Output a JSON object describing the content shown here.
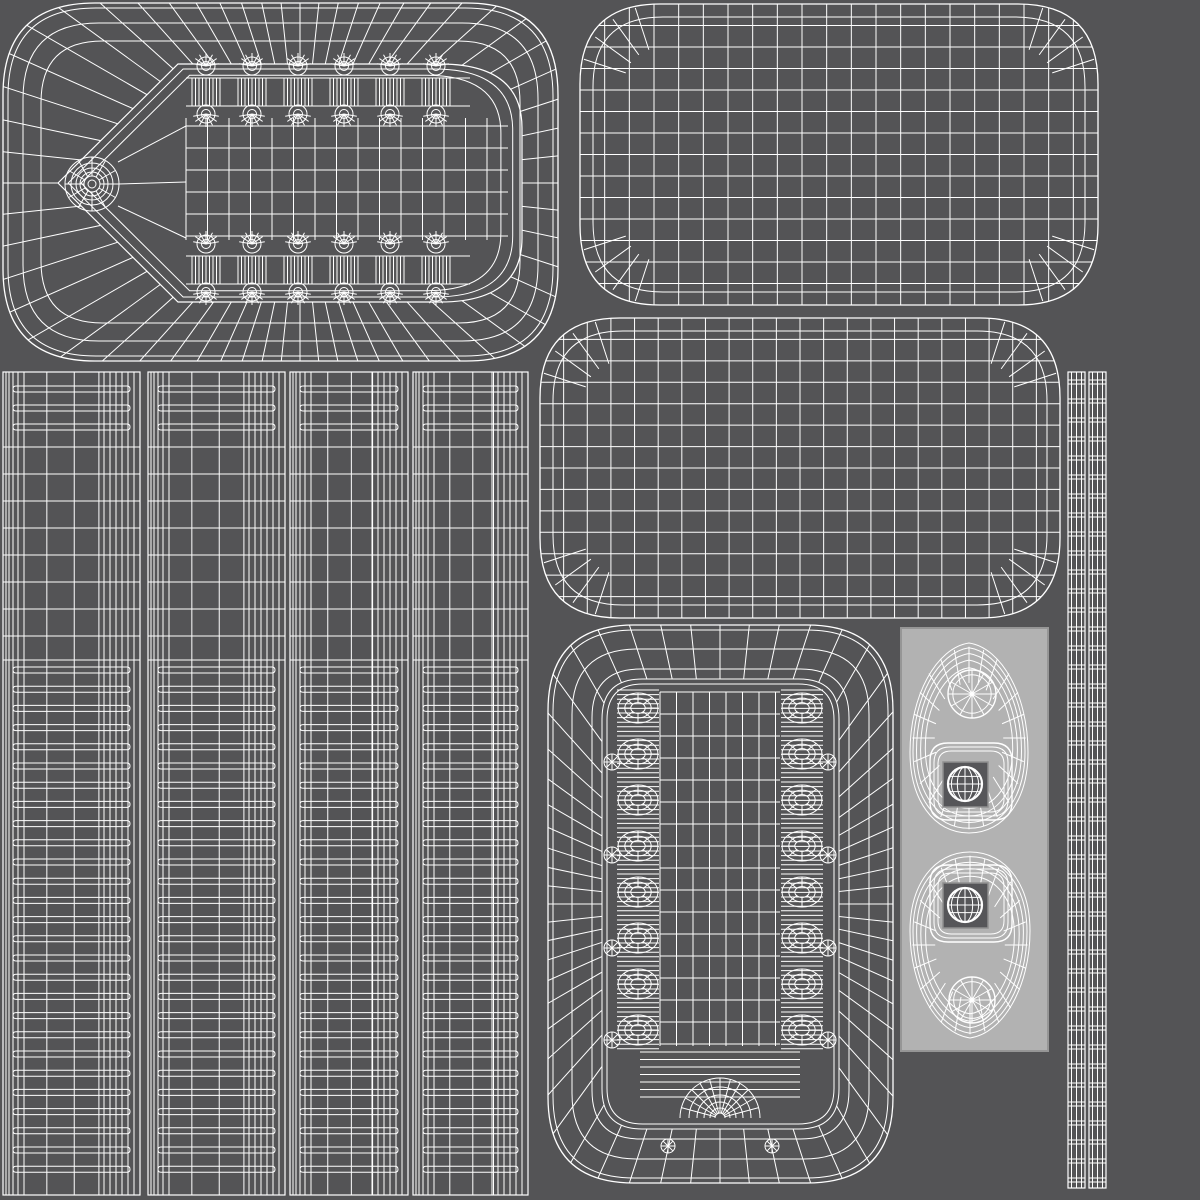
{
  "canvas": {
    "width": 1200,
    "height": 1200
  },
  "colors": {
    "background": "#545456",
    "wire": "#ffffff",
    "panel": "#b2b2b2",
    "panel_border": "#969696",
    "hole": "#565659",
    "hole_border": "#8f8f8f"
  },
  "islands": {
    "plate": {
      "name": "island-appliance-plate",
      "x": 3,
      "y": 3,
      "w": 555,
      "h": 358,
      "r": 92,
      "ring_insets": [
        0,
        5,
        20,
        38
      ],
      "center": [
        300,
        183
      ],
      "outline_pts": [
        [
          58,
          183
        ],
        [
          178,
          64
        ],
        [
          440,
          64
        ],
        [
          522,
          128
        ],
        [
          522,
          238
        ],
        [
          440,
          302
        ],
        [
          178,
          302
        ]
      ],
      "tooth_centers": [
        206,
        252,
        298,
        344,
        390,
        436
      ],
      "teeth_rows": [
        {
          "fan_top": 66,
          "hatch_top": 78,
          "hatch_bottom": 106,
          "fan_bottom": 114
        },
        {
          "fan_top": 244,
          "hatch_top": 256,
          "hatch_bottom": 284,
          "fan_bottom": 292
        }
      ],
      "grid": {
        "x0": 186,
        "x1": 508,
        "y0": 114,
        "y1": 244,
        "v_step": 21.5,
        "rows": [
          126,
          148,
          170,
          192,
          214,
          236
        ]
      },
      "hinge_circles": {
        "cx": 92,
        "cy": 184,
        "radii": [
          4,
          8,
          12,
          16,
          21,
          27
        ]
      }
    },
    "grid_stadium_top": {
      "name": "island-lid-top-grid",
      "x": 580,
      "y": 4,
      "w": 518,
      "h": 301,
      "r": 80,
      "cols": 21,
      "rows": 14
    },
    "grid_stadium_mid": {
      "name": "island-lid-bottom-grid",
      "x": 540,
      "y": 318,
      "w": 520,
      "h": 300,
      "r": 80,
      "cols": 22,
      "rows": 14
    },
    "strips": {
      "name": "island-side-wall-strips",
      "y": 372,
      "h": 823,
      "items": [
        {
          "x": 3,
          "w": 137
        },
        {
          "x": 148,
          "w": 137
        },
        {
          "x": 290,
          "w": 118
        },
        {
          "x": 413,
          "w": 115
        }
      ],
      "left_cluster": [
        0,
        3,
        6,
        10,
        15,
        21
      ],
      "column_fracs": [
        0.32,
        0.52,
        0.7
      ],
      "right_cluster_offsets": [
        36,
        30,
        24,
        18,
        12,
        6
      ],
      "top_capsules": [
        389,
        408,
        427
      ],
      "plain_rows": [
        447,
        474,
        501,
        528,
        555,
        582,
        609,
        636,
        660
      ],
      "capsules": {
        "start": 670,
        "step": 19.2,
        "end": 1186,
        "height": 6
      }
    },
    "arch_tray": {
      "name": "island-arch-tray",
      "x": 548,
      "y": 625,
      "w": 345,
      "h": 558,
      "r": 86,
      "ring_insets": [
        0,
        5,
        24,
        44,
        54,
        59
      ],
      "rim_inset": 54,
      "center": [
        720,
        904
      ],
      "rib_columns": [
        {
          "cx": 638
        },
        {
          "cx": 802
        }
      ],
      "rib_half_width": 21,
      "rib_unit_ys": [
        708,
        754,
        800,
        846,
        892,
        938,
        984,
        1030
      ],
      "rib_hatch": {
        "y0": 690,
        "y1": 1050,
        "step": 4.6
      },
      "grid": {
        "x0": 660,
        "x1": 780,
        "y0": 692,
        "y1": 1046,
        "v_step": 16.5,
        "h_step": 22
      },
      "bottom_stack": {
        "x0": 640,
        "x1": 800,
        "y0": 1052,
        "y1": 1098,
        "step": 7.5
      },
      "bottom_fan": {
        "cx": 720,
        "cy": 1118,
        "radii": [
          5,
          10,
          16,
          23,
          31,
          40
        ]
      },
      "side_circles": {
        "left_x": 612,
        "right_x": 828,
        "ys": [
          762,
          855,
          948,
          1040
        ],
        "r": 8
      },
      "mini_sunbursts": [
        {
          "cx": 668,
          "cy": 1146
        },
        {
          "cx": 772,
          "cy": 1146
        }
      ]
    },
    "faceplate_panel": {
      "name": "island-faceplate-panel",
      "x": 901,
      "y": 628,
      "w": 147,
      "h": 423,
      "eggs": [
        {
          "name": "egg-mesh-top",
          "cx": 969,
          "y_top": 643,
          "y_bottom": 833,
          "rx": 59,
          "flip": false,
          "spoke_circle": {
            "cx": 972,
            "cy": 694,
            "r": 24
          },
          "square_ring": {
            "x": 930,
            "y": 743,
            "w": 82,
            "h": 77,
            "r": 18
          },
          "hole_square": {
            "x": 943,
            "y": 762,
            "s": 45
          },
          "globe": {
            "cx": 965,
            "cy": 784,
            "r": 17
          }
        },
        {
          "name": "egg-mesh-bottom",
          "cx": 970,
          "y_top": 852,
          "y_bottom": 1038,
          "rx": 60,
          "flip": true,
          "spoke_circle": {
            "cx": 972,
            "cy": 1000,
            "r": 23
          },
          "square_ring": {
            "x": 930,
            "y": 865,
            "w": 82,
            "h": 77,
            "r": 18
          },
          "hole_square": {
            "x": 943,
            "y": 883,
            "s": 45
          },
          "globe": {
            "cx": 965,
            "cy": 905,
            "r": 17
          }
        }
      ]
    },
    "right_ladders": {
      "name": "island-edge-loop-ladders",
      "y": 372,
      "h": 816,
      "items": [
        {
          "x": 1068,
          "w": 17
        },
        {
          "x": 1089,
          "w": 17
        }
      ],
      "rung_step": 19
    }
  }
}
